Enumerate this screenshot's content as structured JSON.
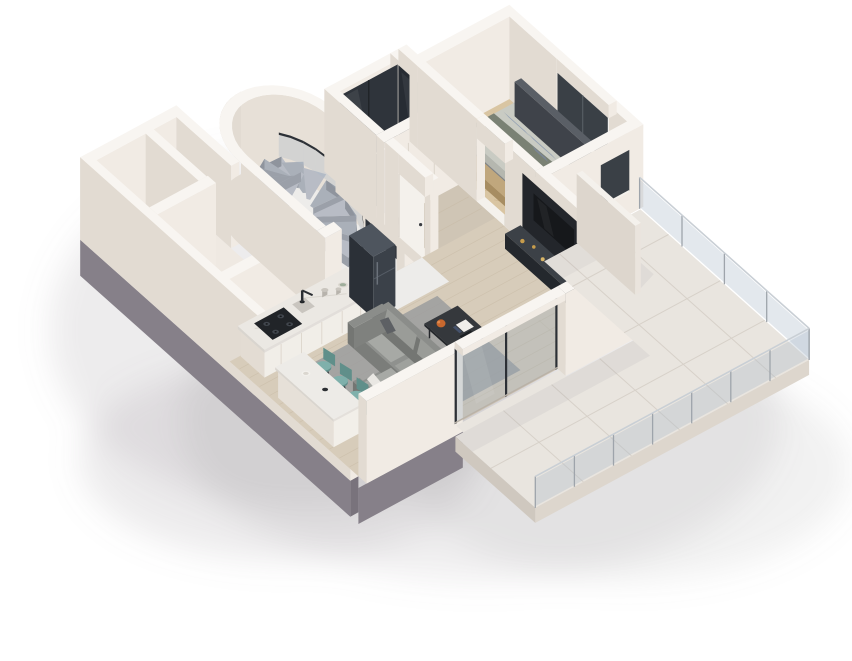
{
  "scene": {
    "title": "3D axonometric cutaway render of a one-bedroom apartment floor plan",
    "style": "isometric dollhouse view, white cut walls, grey base plinth, soft drop shadow",
    "background": "#ffffff"
  },
  "rooms": [
    {
      "id": "west-wing",
      "name": "Bathroom and utility rooms",
      "floor": "light stone"
    },
    {
      "id": "spiral-stair-hall",
      "name": "Curved staircase hall",
      "floor": "white marble"
    },
    {
      "id": "wardrobe-closet",
      "name": "Walk-in wardrobe",
      "floor": "dark"
    },
    {
      "id": "hallway",
      "name": "Hallway",
      "floor": "wood"
    },
    {
      "id": "bedroom",
      "name": "Bedroom",
      "floor": "herringbone parquet"
    },
    {
      "id": "living-kitchen",
      "name": "Open-plan kitchen and living room",
      "floor": "light wood"
    },
    {
      "id": "balcony",
      "name": "Tiled balcony terrace",
      "floor": "large format tiles"
    }
  ],
  "furniture": [
    {
      "id": "spiral-staircase",
      "name": "Marble spiral staircase",
      "room": "spiral-stair-hall",
      "steps": 11
    },
    {
      "id": "stair-handrail",
      "name": "Dark curved handrail with glass balustrade",
      "room": "spiral-stair-hall"
    },
    {
      "id": "entry-glass-door",
      "name": "Dark framed glass door",
      "room": "spiral-stair-hall"
    },
    {
      "id": "wardrobe-glass-doors",
      "name": "Dark glass wardrobe front",
      "room": "wardrobe-closet"
    },
    {
      "id": "interior-doors",
      "name": "White interior doors with dark handles",
      "room": "hallway",
      "count": 2
    },
    {
      "id": "double-bed",
      "name": "Double bed, blue-grey pillows, sage throw",
      "room": "bedroom",
      "pillows": 4
    },
    {
      "id": "bed-bench",
      "name": "Wooden foot bench",
      "room": "bedroom"
    },
    {
      "id": "nightstand",
      "name": "Dark nightstand",
      "room": "bedroom"
    },
    {
      "id": "utility-box",
      "name": "Wall mounted utility box",
      "room": "bedroom"
    },
    {
      "id": "kitchen-counter",
      "name": "Kitchen counter with marble worktop",
      "room": "living-kitchen"
    },
    {
      "id": "gas-cooktop",
      "name": "Black gas cooktop",
      "room": "living-kitchen",
      "burners": 4
    },
    {
      "id": "kitchen-faucet",
      "name": "Black kitchen faucet and sink",
      "room": "living-kitchen"
    },
    {
      "id": "counter-decor",
      "name": "Canisters and green plate",
      "room": "living-kitchen"
    },
    {
      "id": "refrigerator",
      "name": "Dark steel refrigerator",
      "room": "living-kitchen"
    },
    {
      "id": "tv-media-wall",
      "name": "Dark TV media wall with console and gold decor",
      "room": "living-kitchen"
    },
    {
      "id": "area-rug",
      "name": "Grey area rug",
      "room": "living-kitchen"
    },
    {
      "id": "sectional-sofa",
      "name": "Grey L-shaped sectional sofa",
      "room": "living-kitchen"
    },
    {
      "id": "coffee-table",
      "name": "Dark coffee table with orange vase and books",
      "room": "living-kitchen"
    },
    {
      "id": "bar-stools",
      "name": "Teal bar stools",
      "room": "living-kitchen",
      "count": 3
    },
    {
      "id": "kitchen-island",
      "name": "White kitchen island",
      "room": "living-kitchen"
    },
    {
      "id": "sliding-glass-door",
      "name": "Sliding glass door to balcony",
      "room": "living-kitchen"
    },
    {
      "id": "privacy-screen",
      "name": "White privacy screen",
      "room": "balcony"
    },
    {
      "id": "balcony-railing",
      "name": "Glass balcony railing",
      "room": "balcony"
    }
  ],
  "palette": {
    "bg": "#ffffff",
    "wallTop": "#f8f5f1",
    "wallLit": "#f1ebe4",
    "wallShade": "#e2dbd2",
    "wallInner": "#e7e0d7",
    "plinth": "#868089",
    "plinthDark": "#79737c",
    "marble": "#edecea",
    "marbleVein": "#d9d7d4",
    "wood": "#d7ccba",
    "woodLine": "#c5b8a2",
    "hallWood": "#cfc5b5",
    "herring": "#d9c5a2",
    "herringLine": "#c2aa83",
    "tile": "#e9e5df",
    "tileLine": "#d7d1c9",
    "slabEdge": "#ddd6cd",
    "darkGlass": "#2f343b",
    "darkGlass2": "#272c33",
    "railGlass": "rgba(170,186,200,0.33)",
    "railPost": "#9ea4ab",
    "railTop": "#c9cfd5",
    "doorWhite": "#f4f1ec",
    "handle": "#3a3d42",
    "counterFront": "#f1eee8",
    "counterSide": "#e3dcd3",
    "counterTop": "#ebe8e3",
    "seam": "#dcd5cb",
    "stoveTop": "#212428",
    "burner": "#41464d",
    "fridgeFront": "#3b4149",
    "fridgeSide": "#2b3037",
    "fridgeTop": "#4e555e",
    "stepA": "#b8bcc5",
    "stepB": "#aab0b9",
    "stepFace": "#8f949d",
    "stepSide": "#9ba0a9",
    "rail": "#2c3036",
    "sofa": "#8f918e",
    "sofaDark": "#7b7d7a",
    "sofaMid": "#848683",
    "cushion": "#a7a9a5",
    "pillowDark": "#5d6064",
    "pillowWhite": "#e9e7e3",
    "rug": "#9b9c9e",
    "tableTop": "#35383c",
    "tableDark": "#24272b",
    "orange": "#c8682e",
    "bookWhite": "#f0eeea",
    "teal": "#7fb0ab",
    "tealDark": "#608f8a",
    "tvPanel": "#23262b",
    "consoleFront": "#2f3338",
    "consoleSide": "#24282d",
    "consoleTop": "#3c4147",
    "gold": "#c79d4c",
    "headboard": "#4b4f56",
    "bedBase": "#8e9196",
    "bedBaseDark": "#7e8287",
    "duvet": "#c9cbc3",
    "duvetShade": "#b5b7af",
    "throw": "#7a8174",
    "pillowBlue": "#94a1b3",
    "pillowBlueLight": "#aab4c2",
    "benchTop": "#c0a77d",
    "benchSide": "#a78d62",
    "windowDark": "#3a4046",
    "brown": "#8b7657",
    "brownDark": "#77644a",
    "brownTop": "#9c8764",
    "shadow": "#8e898c"
  }
}
